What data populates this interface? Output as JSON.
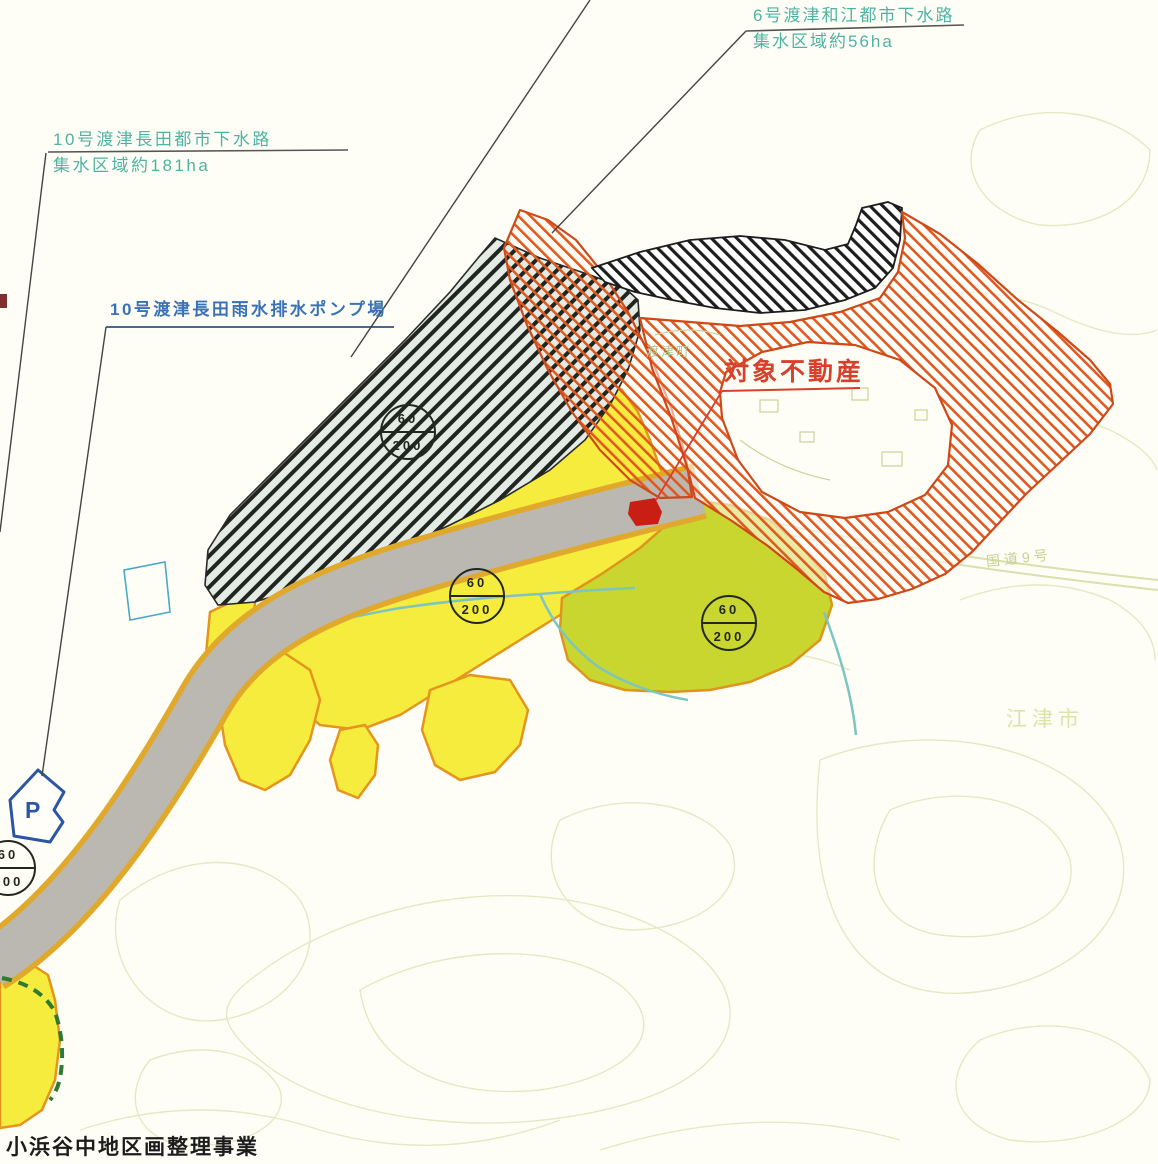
{
  "labels": {
    "sewer_10": {
      "line1": "10号渡津長田都市下水路",
      "line2": "集水区域約181ha"
    },
    "sewer_6": {
      "line1": "6号渡津和江都市下水路",
      "line2": "集水区域約56ha"
    },
    "pump_10": {
      "text": "10号渡津長田雨水排水ポンプ場"
    },
    "subject_property": {
      "text": "対象不動産"
    },
    "town_watazu": {
      "text": "渡津町"
    },
    "route_9": {
      "text": "国道9号"
    },
    "city_gotsu": {
      "text": "江津市"
    },
    "bottom_note": {
      "text": "小浜谷中地区画整理事業"
    },
    "parking_mark": {
      "text": "P"
    }
  },
  "zoning_badges": [
    {
      "coverage": "60",
      "floor_area": "200",
      "x": 408,
      "y": 432
    },
    {
      "coverage": "60",
      "floor_area": "200",
      "x": 477,
      "y": 596
    },
    {
      "coverage": "60",
      "floor_area": "200",
      "x": 729,
      "y": 623
    },
    {
      "coverage": "60",
      "floor_area": "200",
      "x": 8,
      "y": 868
    }
  ],
  "colors": {
    "sewer_label": "#4fb3a2",
    "pump_label": "#3a72b8",
    "subject_label": "#d8402c",
    "subject_building": "#c81e14",
    "yellow_zone": "#f5ec3e",
    "olive_zone": "#c9d62f",
    "hatch_band_bg": "#e3ebe4",
    "orange_hatch": "#e05a20",
    "road_gray": "#bab8b0",
    "parking_blue": "#2b55a5",
    "stream_teal": "#7cc6bf"
  }
}
